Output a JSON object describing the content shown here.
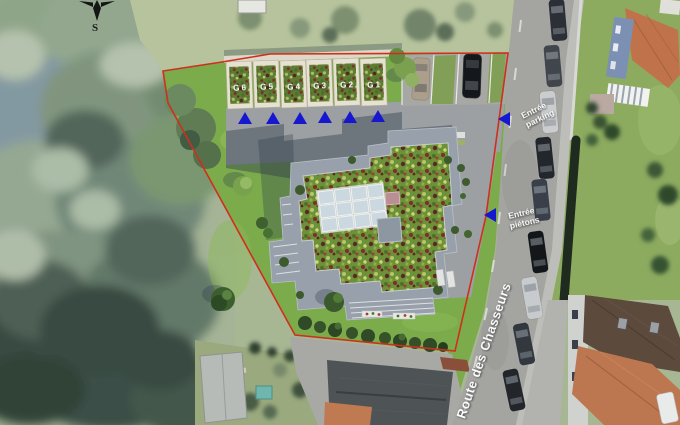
{
  "scene": {
    "compass": {
      "south_label": "S"
    },
    "garage_labels": [
      "G 6",
      "G 5",
      "G 4",
      "G 3",
      "G 2",
      "G 1"
    ],
    "entrance_labels": {
      "parking": [
        "Entrée",
        "parking"
      ],
      "pedestrian": [
        "Entrée",
        "piétons"
      ]
    },
    "street_name": "Route des Chasseurs",
    "colors": {
      "boundary_red": "#cf2f1d",
      "arrow_blue": "#1717cf",
      "site_lawn_green": "#7cab4c",
      "garage_roof_green": "#5e7c33",
      "building_roof_green": "#6d9138",
      "building_deck_gray": "#97a0ab",
      "road_gray": "#a4a5a1",
      "orange_roof": "#c0734a"
    }
  }
}
